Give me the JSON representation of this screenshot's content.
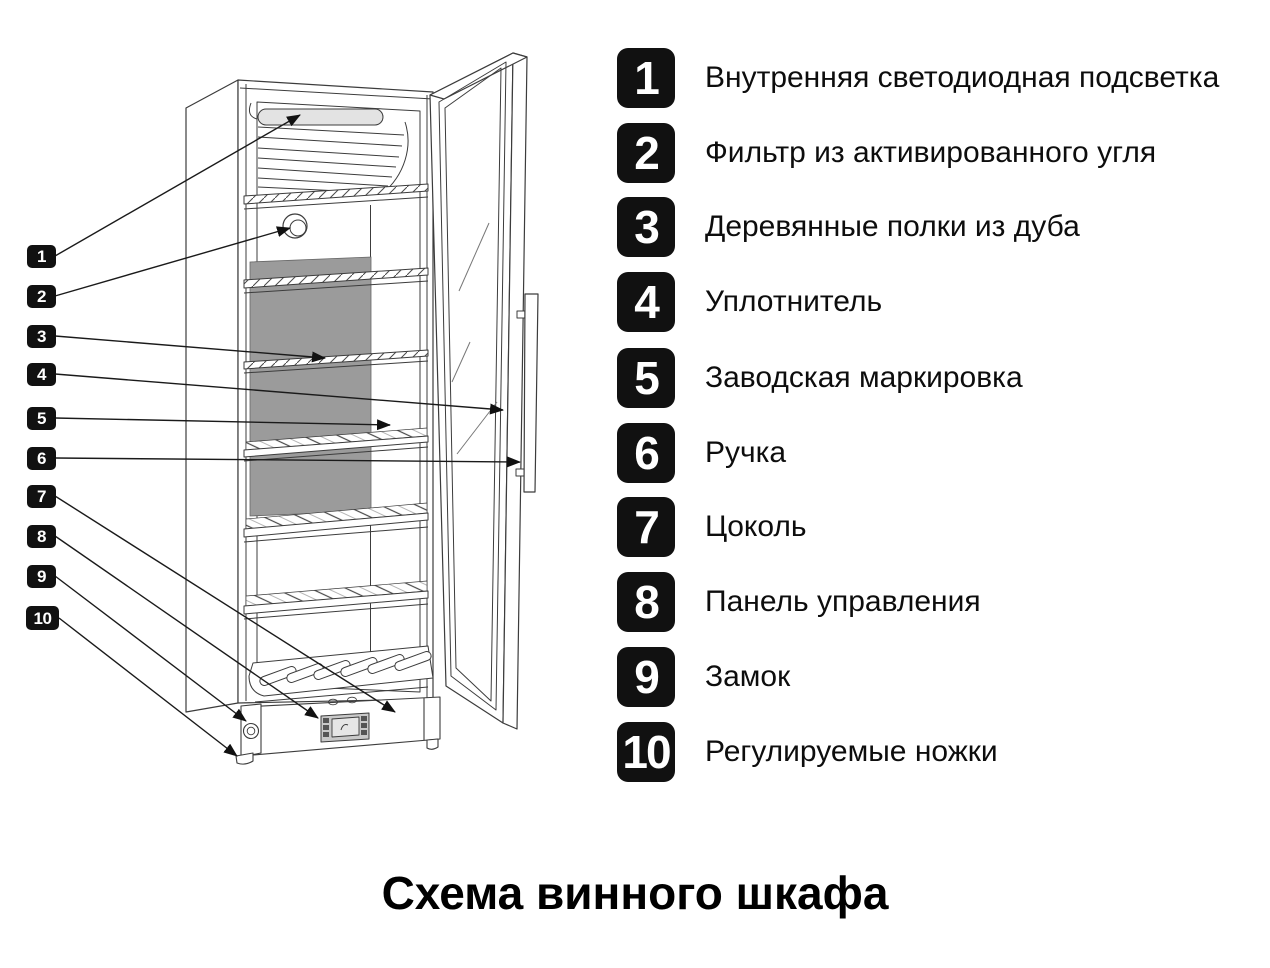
{
  "title": "Схема винного шкафа",
  "legend": {
    "items": [
      {
        "number": "1",
        "label": "Внутренняя светодиодная подсветка"
      },
      {
        "number": "2",
        "label": "Фильтр из активированного угля"
      },
      {
        "number": "3",
        "label": "Деревянные полки из дуба"
      },
      {
        "number": "4",
        "label": "Уплотнитель"
      },
      {
        "number": "5",
        "label": "Заводская маркировка"
      },
      {
        "number": "6",
        "label": "Ручка"
      },
      {
        "number": "7",
        "label": "Цоколь"
      },
      {
        "number": "8",
        "label": "Панель управления"
      },
      {
        "number": "9",
        "label": "Замок"
      },
      {
        "number": "10",
        "label": "Регулируемые ножки"
      }
    ]
  },
  "diagram": {
    "markers": [
      {
        "number": "1"
      },
      {
        "number": "2"
      },
      {
        "number": "3"
      },
      {
        "number": "4"
      },
      {
        "number": "5"
      },
      {
        "number": "6"
      },
      {
        "number": "7"
      },
      {
        "number": "8"
      },
      {
        "number": "9"
      },
      {
        "number": "10"
      }
    ],
    "colors": {
      "badge_bg": "#111111",
      "badge_text": "#ffffff",
      "panel_gray": "#9b9b9b",
      "outline": "#3c3c3c",
      "led_pill": "#e3e3e3"
    }
  }
}
